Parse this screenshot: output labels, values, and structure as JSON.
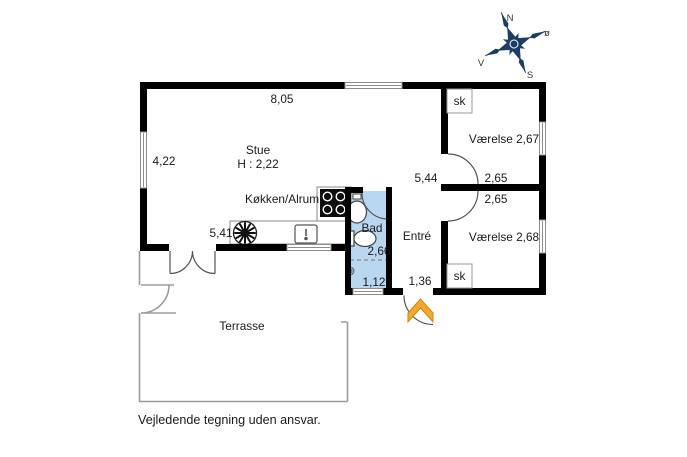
{
  "plan": {
    "rooms": {
      "stue": {
        "name": "Stue",
        "ceiling_height": "H : 2,22"
      },
      "kitchen": {
        "name": "Køkken/Alrum"
      },
      "bath": {
        "name": "Bad"
      },
      "hall": {
        "name": "Entré"
      },
      "bedroom1": {
        "name": "Værelse 2,67"
      },
      "bedroom2": {
        "name": "Værelse 2,68"
      },
      "terrace": {
        "name": "Terrasse"
      },
      "closet_top": {
        "name": "sk"
      },
      "closet_bottom": {
        "name": "sk"
      }
    },
    "measurements": {
      "top_width": "8,05",
      "left_height": "4,22",
      "kitchen_width": "5,41",
      "hall_length": "5,44",
      "bedroom1_width": "2,65",
      "bedroom2_width": "2,65",
      "bath_length": "2,66",
      "bath_width": "1,12",
      "hall_width": "1,36"
    },
    "compass": {
      "north": "N",
      "east": "ø",
      "south": "S",
      "west": "V"
    },
    "disclaimer": "Vejledende tegning uden ansvar.",
    "colors": {
      "wall": "#000000",
      "bath_fill": "#bad7f2",
      "entrance_arrow": "#f5a733",
      "compass": "#1d3c66",
      "window_frame": "#8c8c8c",
      "terrace_outline": "#9c9c9c"
    }
  }
}
